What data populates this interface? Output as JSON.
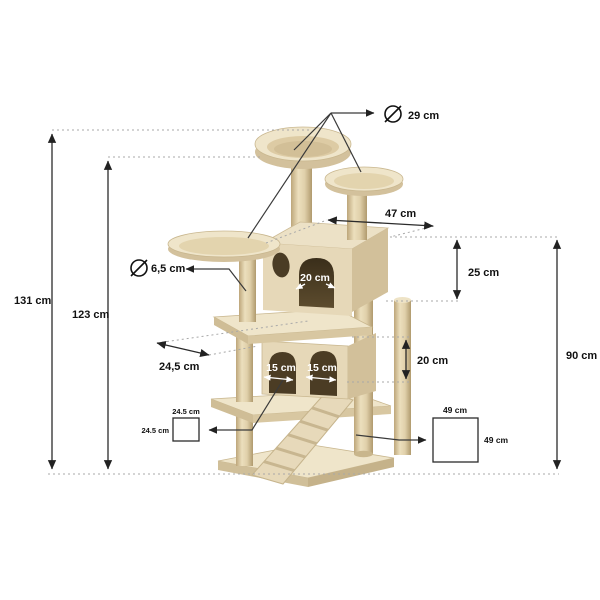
{
  "diagram": {
    "type": "product-dimension-diagram",
    "product": "cat tree scratching post",
    "unit": "cm",
    "labels": {
      "total_height": "131 cm",
      "upper_height": "123 cm",
      "platform_diameter": "29 cm",
      "roof_width": "47 cm",
      "upper_house_height": "25 cm",
      "pole_diameter": "6,5 cm",
      "platform_depth": "24,5 cm",
      "upper_opening_width": "20 cm",
      "lower_opening_left_width": "15 cm",
      "lower_opening_right_width": "15 cm",
      "lower_house_height": "20 cm",
      "tower_height": "90 cm",
      "small_footprint_width": "24.5 cm",
      "small_footprint_depth": "24.5 cm",
      "base_width": "49 cm",
      "base_depth": "49 cm"
    },
    "theme": {
      "bg": "#ffffff",
      "line": "#2b2b2b",
      "dotted": "#a8a8a8",
      "text": "#111111",
      "plush-light": "#efe5ca",
      "plush": "#e6d8b8",
      "plush-dark": "#d3c19c",
      "opening": "#4b3c24"
    }
  }
}
